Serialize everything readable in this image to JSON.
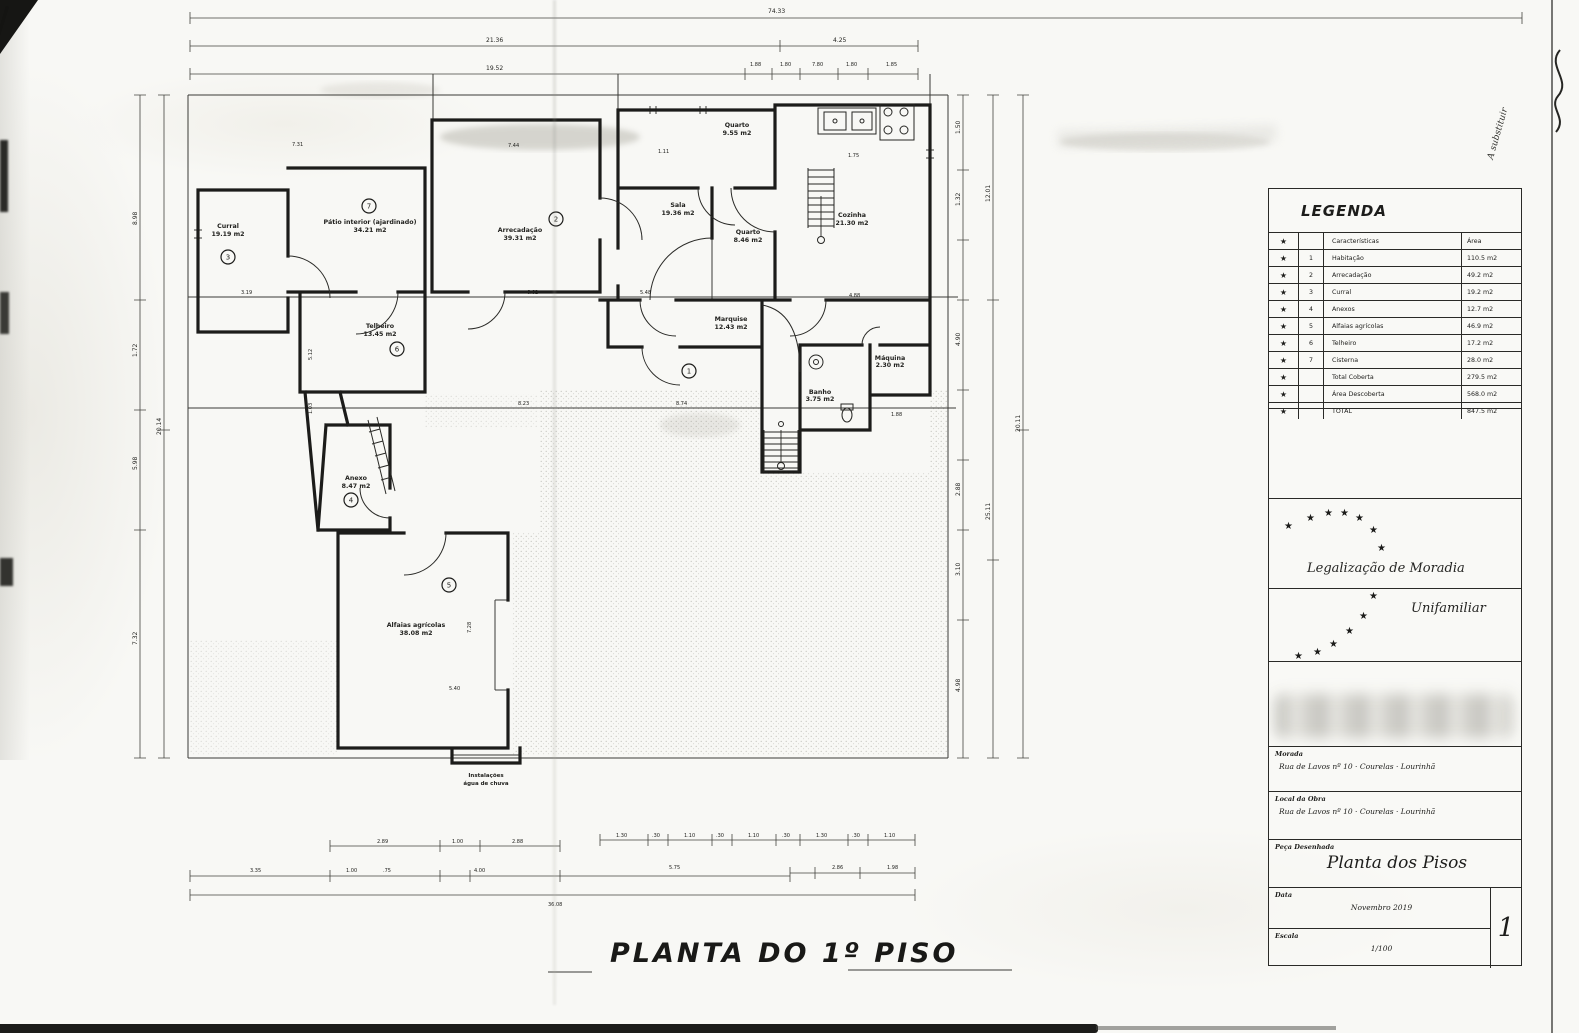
{
  "page": {
    "bottom_title": "PLANTA DO 1º PISO"
  },
  "plan": {
    "rooms": {
      "curral": {
        "name": "Curral",
        "area": "19.19 m2"
      },
      "patio": {
        "name": "Pátio interior (ajardinado)",
        "area": "34.21 m2"
      },
      "arrecadacao": {
        "name": "Arrecadação",
        "area": "39.31 m2"
      },
      "sala": {
        "name": "Sala",
        "area": "19.36 m2"
      },
      "quarto1": {
        "name": "Quarto",
        "area": "9.55 m2"
      },
      "quarto2": {
        "name": "Quarto",
        "area": "8.46 m2"
      },
      "cozinha": {
        "name": "Cozinha",
        "area": "21.30 m2"
      },
      "telheiro": {
        "name": "Telheiro",
        "area": "13.45 m2"
      },
      "marquise": {
        "name": "Marquise",
        "area": "12.43 m2"
      },
      "banho": {
        "name": "Banho",
        "area": "3.75 m2"
      },
      "maquina": {
        "name": "Máquina",
        "area": "2.30 m2"
      },
      "anexo": {
        "name": "Anexo",
        "area": "8.47 m2"
      },
      "alfaias": {
        "name": "Alfaias agrícolas",
        "area": "38.08 m2"
      }
    },
    "circles": {
      "c1": "1",
      "c2": "2",
      "c3": "3",
      "c4": "4",
      "c5": "5",
      "c6": "6",
      "c7": "7"
    },
    "note": {
      "line1": "Instalações",
      "line2": "água de chuva"
    },
    "dims": {
      "t1": "74.33",
      "t2": "21.36",
      "t3": "4.25",
      "t4": "19.52",
      "t5": "1.88",
      "t6": "1.80",
      "t7": "7.80",
      "t8": "1.80",
      "t9": "1.85",
      "l1": "8.98",
      "l2": "1.72",
      "l3": "20.14",
      "l4": "5.98",
      "l5": "7.32",
      "r1": "1.50",
      "r2": "1.32",
      "r3": "12.01",
      "r4": "4.90",
      "r5": "2.88",
      "r6": "3.10",
      "r7": "25.11",
      "r8": "20.11",
      "r9": "4.98",
      "i1": "7.31",
      "i2": "7.44",
      "i3": "1.11",
      "i4": "1.75",
      "i5": "3.19",
      "i6": "6.62",
      "i7": "5.48",
      "i8": "4.88",
      "i9": "8.23",
      "i10": "8.74",
      "i11": "5.12",
      "i12": "1.03",
      "i13": "1.88",
      "i14": "7.28",
      "i15": "5.40",
      "b1": "2.89",
      "b2": "1.00",
      "b3": "2.88",
      "b4": "1.30",
      "b5": ".30",
      "b6": "1.10",
      "b7": ".30",
      "b8": "1.10",
      "b9": ".30",
      "b10": "1.30",
      "b11": ".30",
      "b12": "1.10",
      "b13": "3.35",
      "b14": "1.00",
      "b15": ".75",
      "b16": "4.00",
      "b17": "5.75",
      "b18": "2.86",
      "b19": "1.98",
      "b20": "36.08"
    }
  },
  "legend": {
    "title": "LEGENDA",
    "star": "★",
    "header": {
      "characteristics": "Características",
      "area": "Área"
    },
    "rows": {
      "r1": {
        "num": "1",
        "label": "Habitação",
        "area": "110.5 m2"
      },
      "r2": {
        "num": "2",
        "label": "Arrecadação",
        "area": "49.2 m2"
      },
      "r3": {
        "num": "3",
        "label": "Curral",
        "area": "19.2 m2"
      },
      "r4": {
        "num": "4",
        "label": "Anexos",
        "area": "12.7 m2"
      },
      "r5": {
        "num": "5",
        "label": "Alfaias agrícolas",
        "area": "46.9 m2"
      },
      "r6": {
        "num": "6",
        "label": "Telheiro",
        "area": "17.2 m2"
      },
      "r7": {
        "num": "7",
        "label": "Cisterna",
        "area": "28.0 m2"
      },
      "r8": {
        "num": "",
        "label": "Total Coberta",
        "area": "279.5 m2"
      },
      "r9": {
        "num": "",
        "label": "Área Descoberta",
        "area": "568.0 m2"
      },
      "r10": {
        "num": "",
        "label": "TOTAL",
        "area": "847.5 m2"
      }
    },
    "annotation": "A substituir"
  },
  "stamp": {
    "line1": "Legalização de Moradia",
    "line2": "Unifamiliar"
  },
  "titleblock": {
    "morada_label": "Morada",
    "morada_value": "Rua de Lavos nº 10  ·  Courelas  ·  Lourinhã",
    "local_label": "Local da Obra",
    "local_value": "Rua de Lavos nº 10  ·  Courelas  ·  Lourinhã",
    "peca_label": "Peça Desenhada",
    "peca_value": "Planta dos Pisos",
    "data_label": "Data",
    "data_value": "Novembro 2019",
    "escala_label": "Escala",
    "escala_value": "1/100",
    "sheet_number": "1"
  }
}
